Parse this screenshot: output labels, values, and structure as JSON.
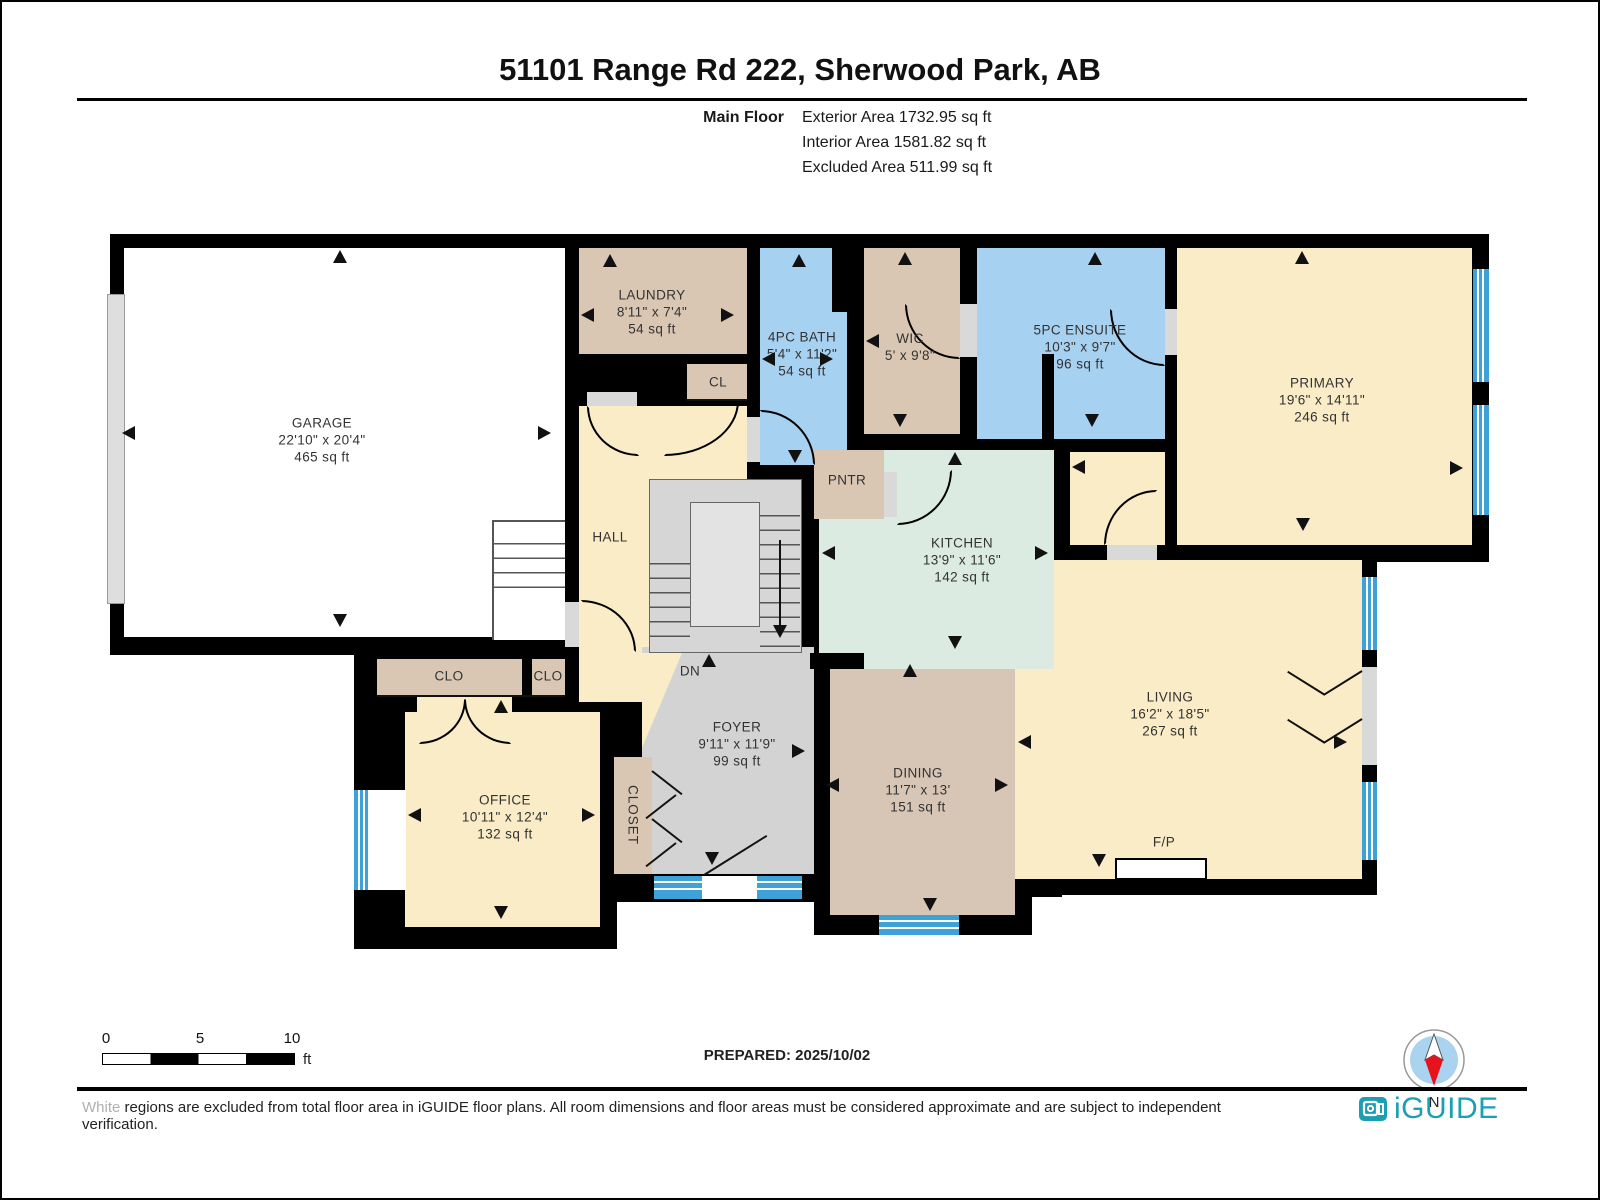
{
  "header": {
    "title": "51101 Range Rd 222, Sherwood Park, AB",
    "floor_label": "Main Floor",
    "exterior_area": "Exterior Area 1732.95 sq ft",
    "interior_area": "Interior Area 1581.82 sq ft",
    "excluded_area": "Excluded Area 511.99 sq ft"
  },
  "rooms": {
    "garage": {
      "name": "GARAGE",
      "dims": "22'10\" x 20'4\"",
      "area": "465 sq ft"
    },
    "laundry": {
      "name": "LAUNDRY",
      "dims": "8'11\" x 7'4\"",
      "area": "54 sq ft"
    },
    "cl": {
      "name": "CL"
    },
    "bath": {
      "name": "4PC BATH",
      "dims": "5'4\" x 11'2\"",
      "area": "54 sq ft"
    },
    "wic": {
      "name": "WIC",
      "dims": "5' x 9'8\""
    },
    "ensuite": {
      "name": "5PC ENSUITE",
      "dims": "10'3\" x 9'7\"",
      "area": "96 sq ft"
    },
    "primary": {
      "name": "PRIMARY",
      "dims": "19'6\" x 14'11\"",
      "area": "246 sq ft"
    },
    "hall": {
      "name": "HALL"
    },
    "pntr": {
      "name": "PNTR"
    },
    "kitchen": {
      "name": "KITCHEN",
      "dims": "13'9\" x 11'6\"",
      "area": "142 sq ft"
    },
    "clo1": {
      "name": "CLO"
    },
    "clo2": {
      "name": "CLO"
    },
    "office": {
      "name": "OFFICE",
      "dims": "10'11\" x 12'4\"",
      "area": "132 sq ft"
    },
    "closet": {
      "name": "CLOSET"
    },
    "foyer": {
      "name": "FOYER",
      "dims": "9'11\" x 11'9\"",
      "area": "99 sq ft"
    },
    "dining": {
      "name": "DINING",
      "dims": "11'7\" x 13'",
      "area": "151 sq ft"
    },
    "living": {
      "name": "LIVING",
      "dims": "16'2\" x 18'5\"",
      "area": "267 sq ft"
    },
    "fp": {
      "name": "F/P"
    },
    "stairs": {
      "name": "DN"
    }
  },
  "footer": {
    "prepared": "PREPARED: 2025/10/02",
    "scale": {
      "zero": "0",
      "five": "5",
      "ten": "10",
      "unit": "ft"
    },
    "compass_label": "N",
    "disclaimer_lead": "White",
    "disclaimer_rest": " regions are excluded from total floor area in iGUIDE floor plans. All room dimensions and floor areas must be considered approximate and are subject to independent verification.",
    "brand": "iGUIDE"
  },
  "colors": {
    "wall": "#000000",
    "tan": "#d9c7b4",
    "blue_room": "#a7d1f0",
    "cream": "#f9ecc6",
    "mint": "#dcebe1",
    "gray_floor": "#d3d3d3",
    "window": "#3ea2d8",
    "brand_teal": "#1b9fb3",
    "compass_red": "#e8121c",
    "compass_blue": "#a9d3ee"
  }
}
